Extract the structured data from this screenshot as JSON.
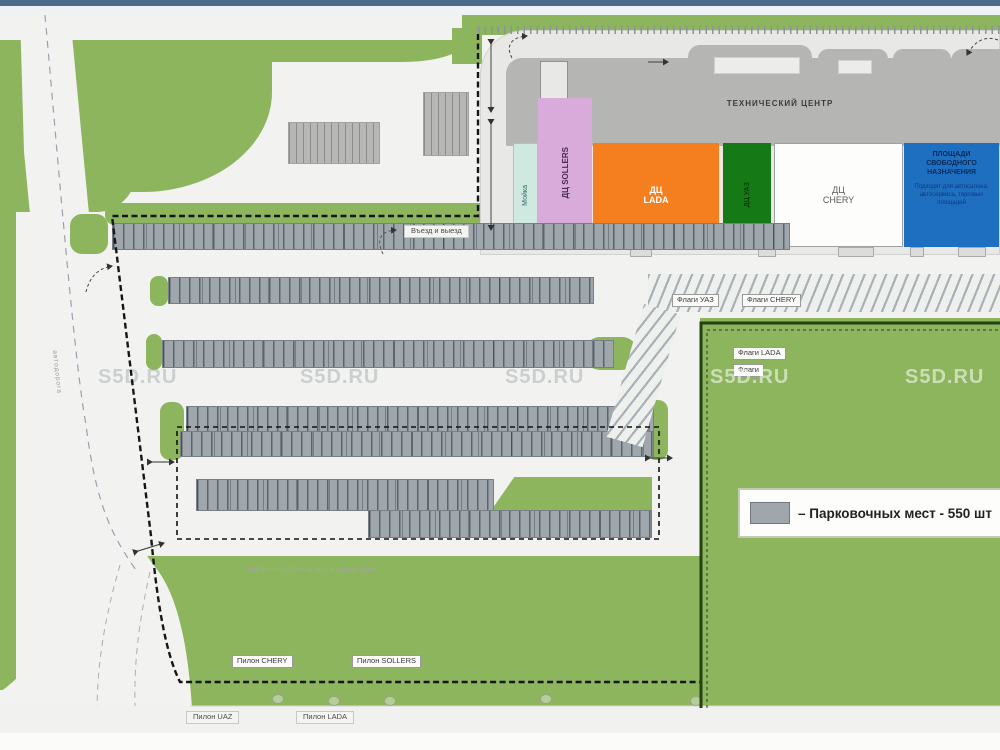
{
  "watermark": "S5D.RU",
  "header": {
    "bar_color": "#4c6a89"
  },
  "plan": {
    "technical_center": "ТЕХНИЧЕСКИЙ ЦЕНТР",
    "blocks": {
      "carwash": "Мойка",
      "sollers": "ДЦ SOLLERS",
      "lada": "ДЦ LADA",
      "uaz": "ДЦ УАЗ",
      "chery": "ДЦ CHERY",
      "free_purpose": {
        "title": "ПЛОЩАДИ СВОБОДНОГО НАЗНАЧЕНИЯ",
        "body": "Подходят для автосалона, автосервиса, торговых площадей"
      }
    },
    "flags": [
      "Флаги УАЗ",
      "Флаги CHERY",
      "Флаги LADA",
      "Флаги"
    ],
    "pylons": [
      "Пилон CHERY",
      "Пилон SOLLERS",
      "Пилон UAZ",
      "Пилон LADA"
    ],
    "entry_exit": "Въезд и выезд",
    "road_side_label": "автодорога",
    "inner_road_label": "внутренний проезд вдоль территории",
    "legend": {
      "text": "– Парковочных мест - 550 шт",
      "swatch": "#9fa7ad"
    },
    "colors": {
      "site_green": "#8cb55e",
      "parking_gray": "#9fa7ad",
      "lada_orange": "#f57e1e",
      "uaz_green": "#157a15",
      "free_blue": "#1e6fc0",
      "sollers_pink": "#d9abdb",
      "carwash_cyan": "#cfe9e1",
      "building_gray": "#b5b5b3"
    }
  }
}
